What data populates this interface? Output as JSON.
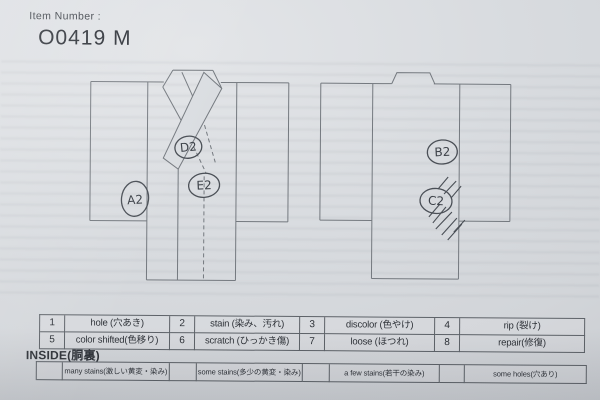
{
  "header": {
    "item_number_label": "Item Number :",
    "item_number_value": "O0419 M"
  },
  "diagrams": {
    "front": {
      "annotations": [
        {
          "label": "A2"
        },
        {
          "label": "D2"
        },
        {
          "label": "E2"
        }
      ]
    },
    "back": {
      "annotations": [
        {
          "label": "B2"
        },
        {
          "label": "C2"
        }
      ]
    }
  },
  "legend": {
    "rows": [
      [
        {
          "num": "1",
          "label": "hole (穴あき)"
        },
        {
          "num": "2",
          "label": "stain (染み、汚れ)"
        },
        {
          "num": "3",
          "label": "discolor (色やけ)"
        },
        {
          "num": "4",
          "label": "rip (裂け)"
        }
      ],
      [
        {
          "num": "5",
          "label": "color shifted(色移り)"
        },
        {
          "num": "6",
          "label": "scratch (ひっかき傷)"
        },
        {
          "num": "7",
          "label": "loose (ほつれ)"
        },
        {
          "num": "8",
          "label": "repair(修復)"
        }
      ]
    ]
  },
  "inside": {
    "title": "INSIDE(胴裏)",
    "options": [
      {
        "label": "many stains(激しい黄変・染み)"
      },
      {
        "label": "some stains(多少の黄変・染み)"
      },
      {
        "label": "a few stains(若干の染み)"
      },
      {
        "label": "some holes(穴あり)"
      }
    ]
  },
  "colors": {
    "paper": "#d8dbdf",
    "drawing_line": "#74797f",
    "pen_ink": "#4a4f56",
    "print_ink": "#2e3238"
  }
}
